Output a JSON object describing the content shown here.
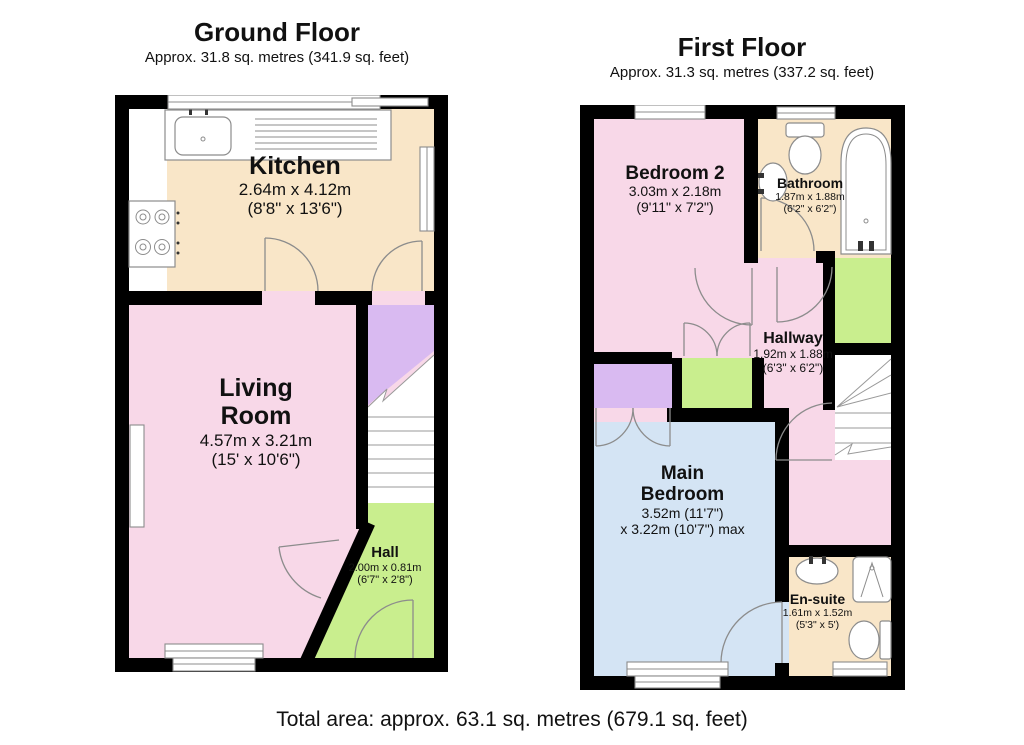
{
  "colors": {
    "wall": "#000000",
    "pink": "#f8d8e8",
    "cream": "#f9e6c8",
    "purple": "#d9baf1",
    "green": "#c9ee8e",
    "blue": "#d4e4f4",
    "outline": "#8c8c8c"
  },
  "ground_floor": {
    "title": "Ground Floor",
    "area": "Approx. 31.8 sq. metres (341.9 sq. feet)",
    "rooms": {
      "kitchen": {
        "name": "Kitchen",
        "metric": "2.64m x 4.12m",
        "imperial": "(8'8\" x 13'6\")"
      },
      "living_room": {
        "name": "Living Room",
        "metric": "4.57m x 3.21m",
        "imperial": "(15' x 10'6\")"
      },
      "hall": {
        "name": "Hall",
        "metric": "2.00m x 0.81m",
        "imperial": "(6'7\" x 2'8\")"
      }
    }
  },
  "first_floor": {
    "title": "First Floor",
    "area": "Approx. 31.3 sq. metres (337.2 sq. feet)",
    "rooms": {
      "bedroom2": {
        "name": "Bedroom 2",
        "metric": "3.03m x 2.18m",
        "imperial": "(9'11\" x 7'2\")"
      },
      "bathroom": {
        "name": "Bathroom",
        "metric": "1.87m x 1.88m",
        "imperial": "(6'2\" x 6'2\")"
      },
      "hallway": {
        "name": "Hallway",
        "metric": "1.92m x 1.88m",
        "imperial": "(6'3\" x 6'2\")"
      },
      "main_bedroom": {
        "name": "Main Bedroom",
        "metric": "3.52m (11'7\")",
        "metric2": "x 3.22m (10'7\") max"
      },
      "ensuite": {
        "name": "En-suite",
        "metric": "1.61m x 1.52m",
        "imperial": "(5'3\" x 5')"
      }
    }
  },
  "footer": {
    "total_area": "Total area: approx. 63.1 sq. metres (679.1 sq. feet)"
  }
}
